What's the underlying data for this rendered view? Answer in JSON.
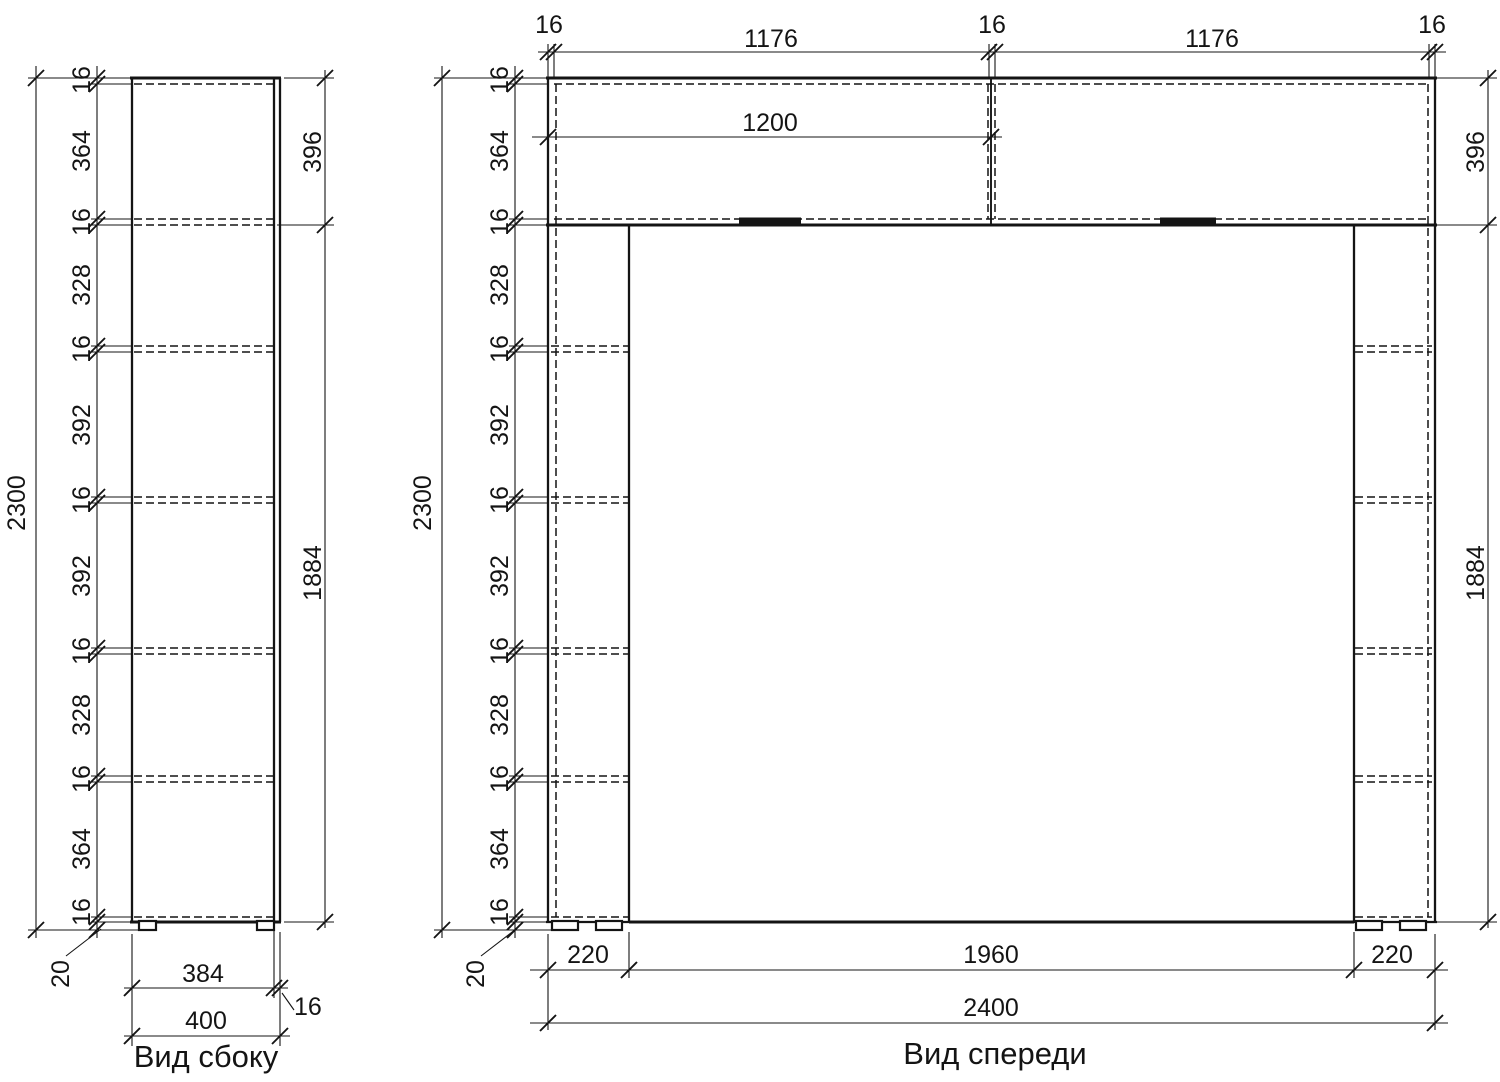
{
  "side_view": {
    "title": "Вид сбоку",
    "overall_height": "2300",
    "height_chain": [
      "16",
      "364",
      "16",
      "328",
      "16",
      "392",
      "16",
      "392",
      "16",
      "328",
      "16",
      "364",
      "16"
    ],
    "upper_height": "396",
    "lower_height": "1884",
    "plinth": "20",
    "body_depth": "384",
    "door_thickness": "16",
    "total_depth": "400"
  },
  "front_view": {
    "title": "Вид спереди",
    "top_chain": [
      "16",
      "1176",
      "16",
      "1176",
      "16"
    ],
    "upper_inner_width": "1200",
    "overall_height": "2300",
    "height_chain": [
      "16",
      "364",
      "16",
      "328",
      "16",
      "392",
      "16",
      "392",
      "16",
      "328",
      "16",
      "364",
      "16"
    ],
    "upper_height": "396",
    "lower_height": "1884",
    "plinth": "20",
    "bottom_chain": [
      "220",
      "1960",
      "220"
    ],
    "overall_width": "2400"
  }
}
